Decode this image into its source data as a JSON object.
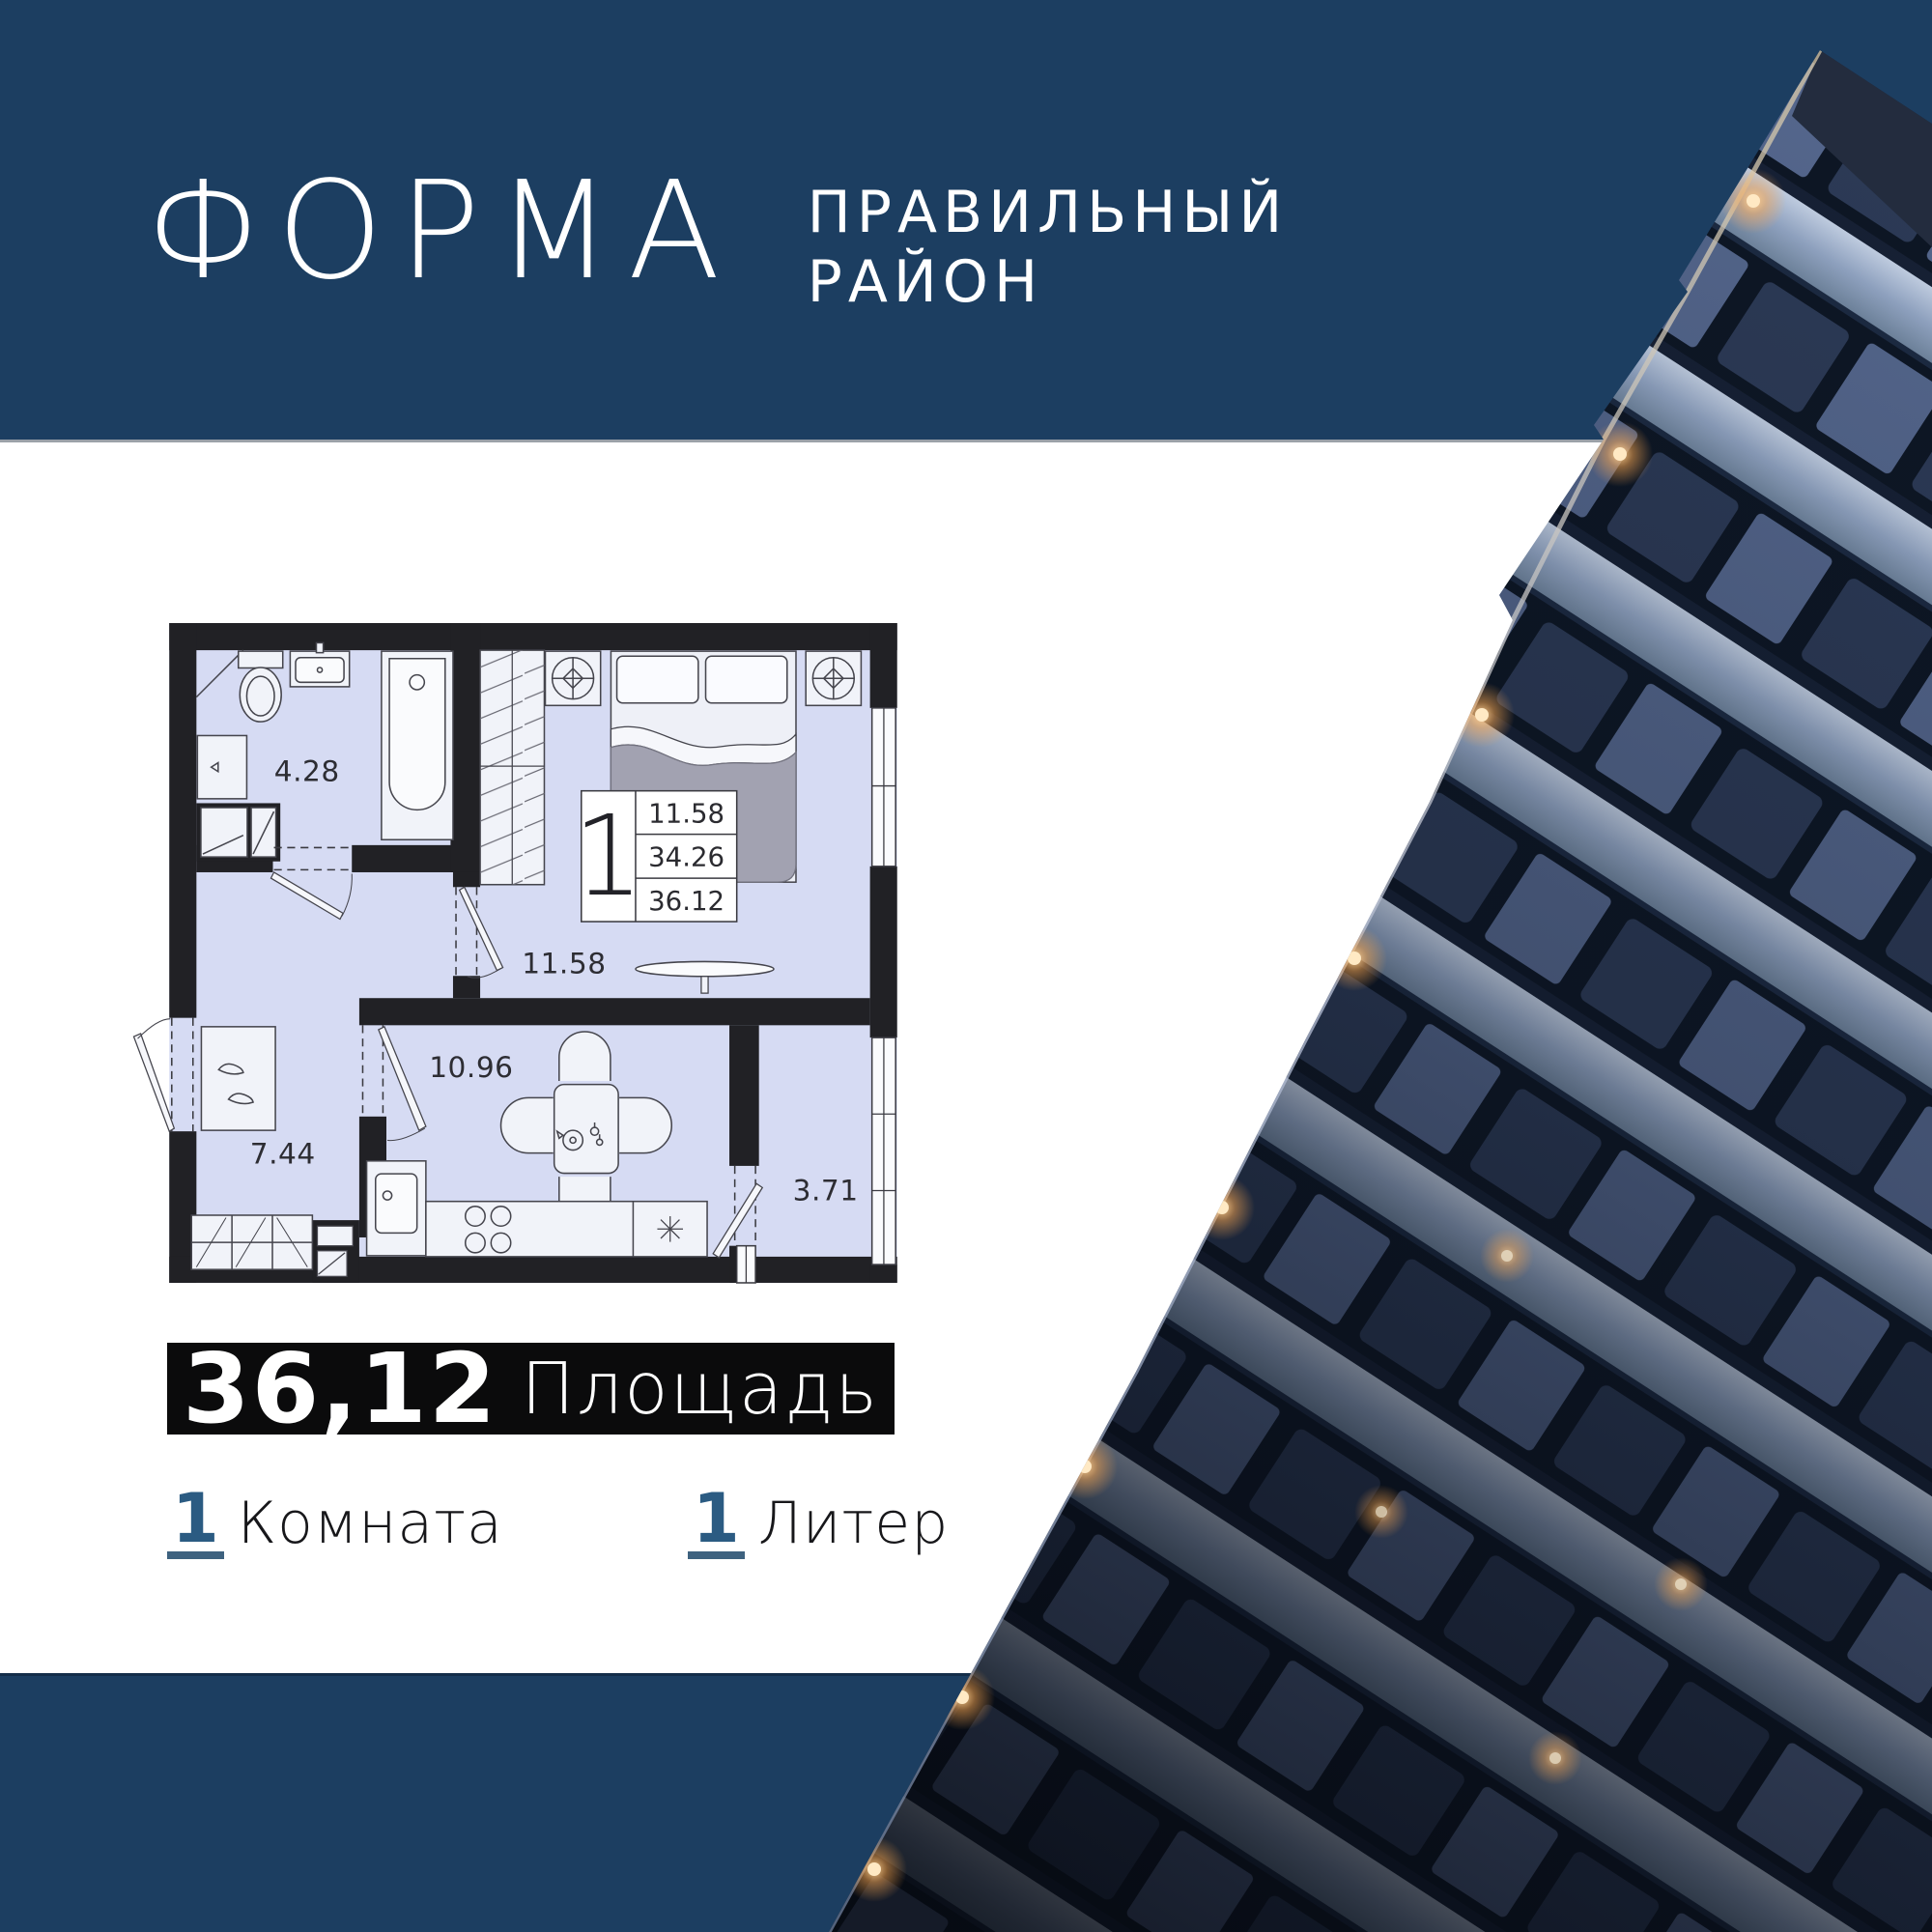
{
  "header": {
    "brand": "ФОРМА",
    "subtitle_line1": "ПРАВИЛЬНЫЙ",
    "subtitle_line2": "РАЙОН"
  },
  "plan": {
    "rooms": [
      {
        "id": "bathroom",
        "area": "4.28"
      },
      {
        "id": "living-room",
        "area": "11.58"
      },
      {
        "id": "kitchen-living",
        "area": "10.96"
      },
      {
        "id": "hallway",
        "area": "7.44"
      },
      {
        "id": "balcony",
        "area": "3.71"
      }
    ],
    "info_box": {
      "rooms_count": "1",
      "living_area": "11.58",
      "apartment_area": "34.26",
      "total_area": "36.12"
    }
  },
  "badge": {
    "value": "36,12",
    "label": "Площадь"
  },
  "facts": [
    {
      "value": "1",
      "label": "Комната"
    },
    {
      "value": "1",
      "label": "Литер"
    }
  ],
  "colors": {
    "band": "#1C3E61",
    "accent_digit": "#2B5B82",
    "badge_bg": "#0B0B0C",
    "plan_fill": "#D6DBF3",
    "plan_wall": "#212125",
    "light_warm": "#FFD9A0"
  }
}
